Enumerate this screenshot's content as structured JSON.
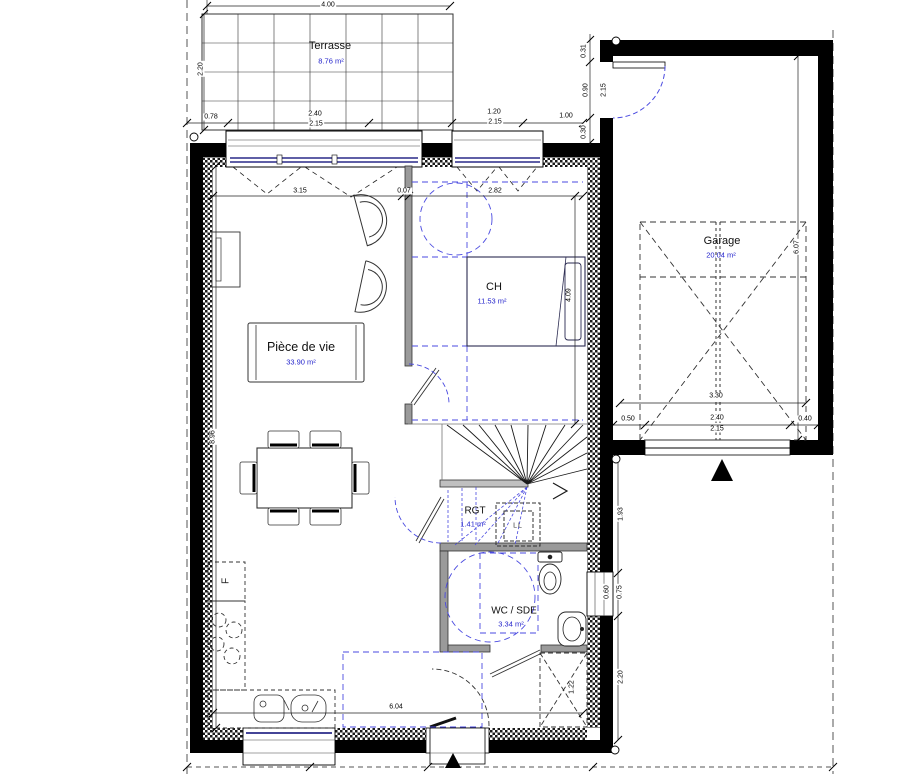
{
  "plan": {
    "rooms": {
      "terrasse": {
        "name": "Terrasse",
        "area": "8.76 m²"
      },
      "living": {
        "name": "Pièce de vie",
        "area": "33.90 m²"
      },
      "bedroom": {
        "name": "CH",
        "area": "11.53 m²"
      },
      "garage": {
        "name": "Garage",
        "area": "20.04 m²"
      },
      "storage": {
        "name": "RGT",
        "area": "1.41 m²"
      },
      "bathroom": {
        "name": "WC / SDE",
        "area": "3.34 m²"
      }
    },
    "appliances": {
      "fridge": "F",
      "washing_machine": "LL"
    },
    "dimensions": {
      "terrace_width": "4.00",
      "terrace_depth": "2.20",
      "front_seg1": "0.78",
      "bay_width": "2.40",
      "bay_glass": "2.15",
      "ch_window_width": "1.20",
      "ch_window_glass": "2.15",
      "front_seg2": "1.00",
      "garage_side_offset": "0.31",
      "garage_side_door_width": "0.90",
      "garage_side_door_height": "2.15",
      "garage_side_gap": "0.30",
      "living_width": "3.15",
      "partition_thickness": "0.07",
      "bedroom_width": "2.82",
      "bedroom_depth": "4.09",
      "living_depth": "8.96",
      "garage_depth": "6.07",
      "garage_width": "3.30",
      "garage_door_left": "0.50",
      "garage_door_width": "2.40",
      "garage_door_height": "2.15",
      "garage_door_right": "0.40",
      "hall_right": "1.93",
      "wc_window_width": "0.60",
      "wc_window_height": "0.75",
      "entry_right": "2.20",
      "closet_width": "1.22",
      "kitchen_wall": "6.04"
    },
    "colors": {
      "wall": "#000000",
      "partition": "#9a9a9a",
      "area_text": "#2424cc",
      "guide_blue": "#4a4ae0",
      "glazing": "#2a2a88"
    }
  }
}
